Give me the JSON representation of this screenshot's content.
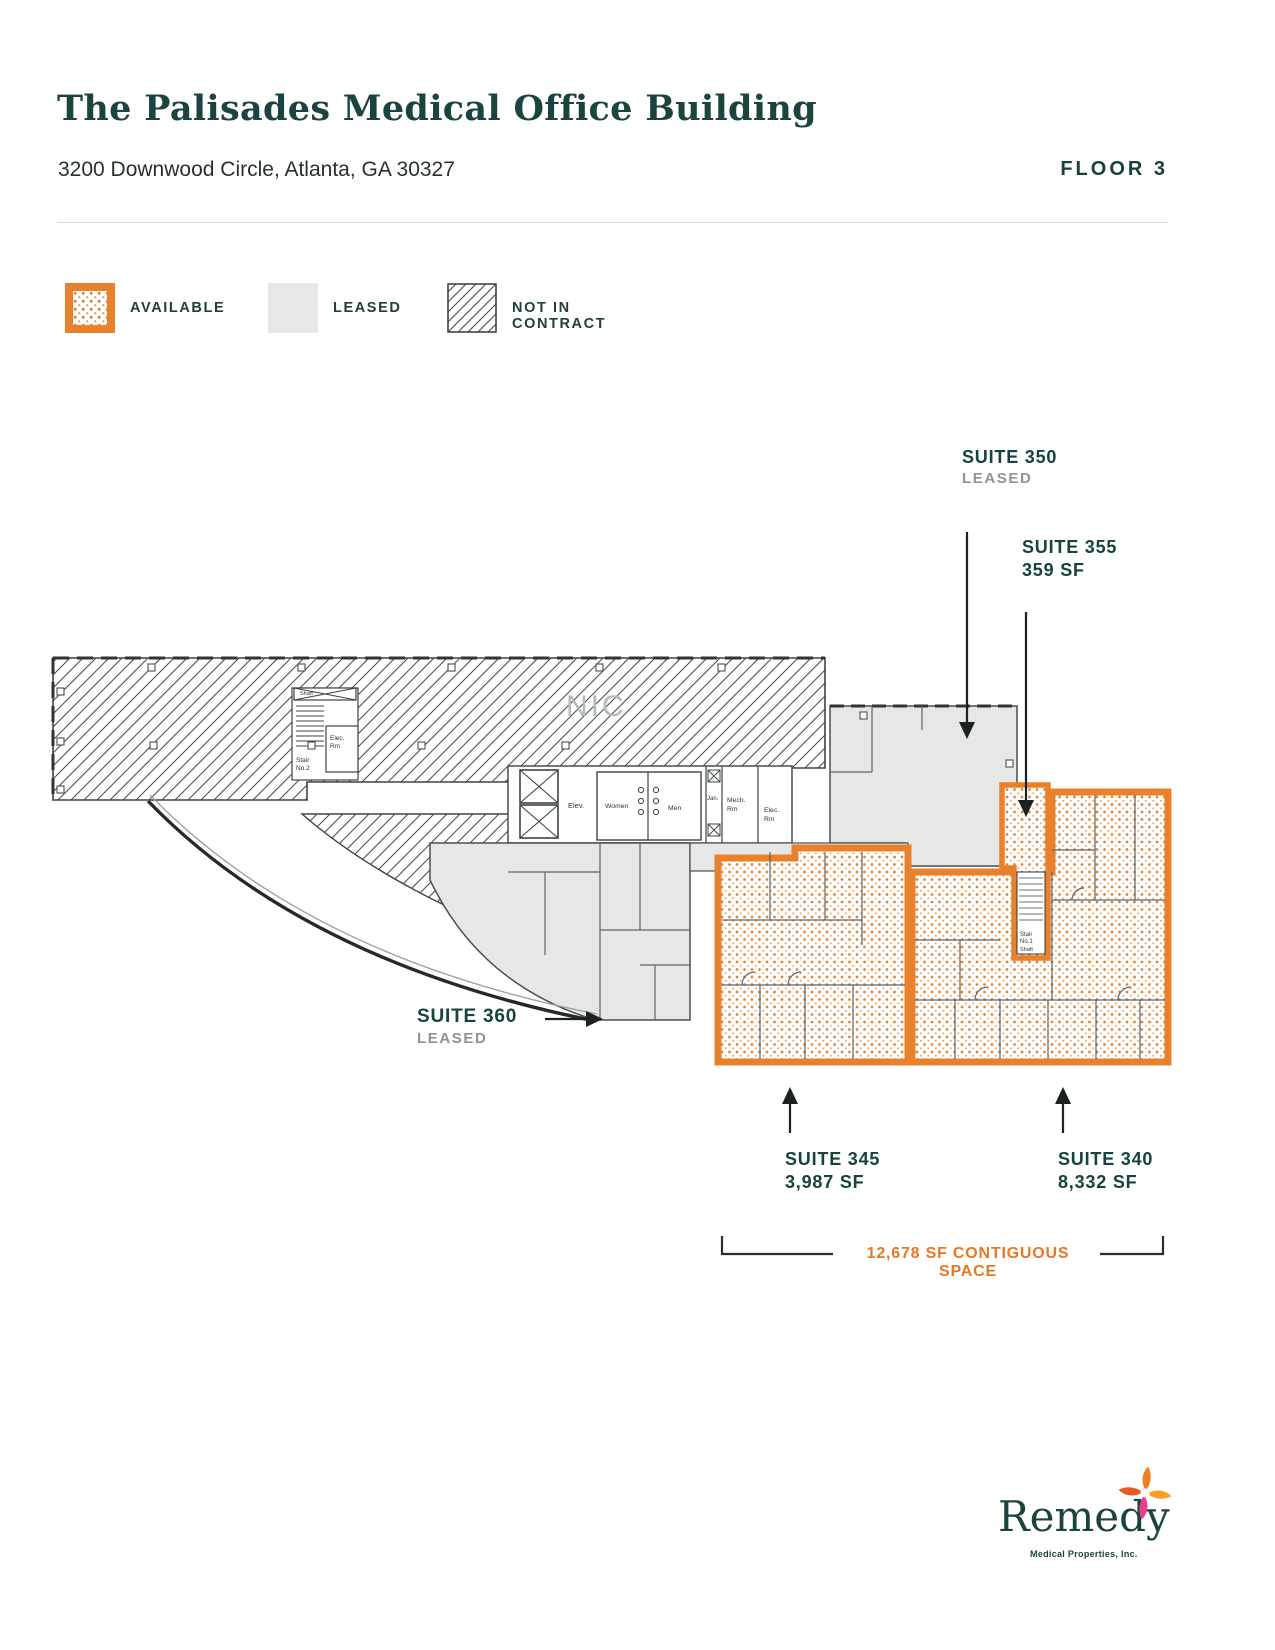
{
  "header": {
    "title": "The Palisades Medical Office Building",
    "address": "3200 Downwood Circle, Atlanta, GA 30327",
    "floor_label": "FLOOR 3"
  },
  "legend": {
    "available": "AVAILABLE",
    "leased": "LEASED",
    "not_in_contract": "NOT IN CONTRACT"
  },
  "callouts": {
    "suite350": {
      "name": "SUITE 350",
      "status": "LEASED"
    },
    "suite355": {
      "name": "SUITE 355",
      "area": "359 SF"
    },
    "suite360": {
      "name": "SUITE 360",
      "status": "LEASED"
    },
    "suite345": {
      "name": "SUITE 345",
      "area": "3,987 SF"
    },
    "suite340": {
      "name": "SUITE 340",
      "area": "8,332 SF"
    },
    "contiguous": "12,678 SF CONTIGUOUS SPACE"
  },
  "plan_labels": {
    "nic": "NIC",
    "elev": "Elev.",
    "women": "Women",
    "men": "Men",
    "jan": "Jan.",
    "mech_line1": "Mech.",
    "mech_line2": "Rm",
    "elec_line1": "Elec.",
    "elec_line2": "Rm",
    "stair_line1": "Stair",
    "stair1_line2": "No.1",
    "stair2_line2": "No.2",
    "shaft": "Shaft"
  },
  "logo": {
    "name": "Remedy",
    "tagline": "Medical Properties, Inc."
  },
  "colors": {
    "available_orange": "#E8802C",
    "orange_text": "#E87724",
    "leased_fill": "#E7E7E6",
    "teal": "#1B4441",
    "status_gray": "#8F9492"
  }
}
